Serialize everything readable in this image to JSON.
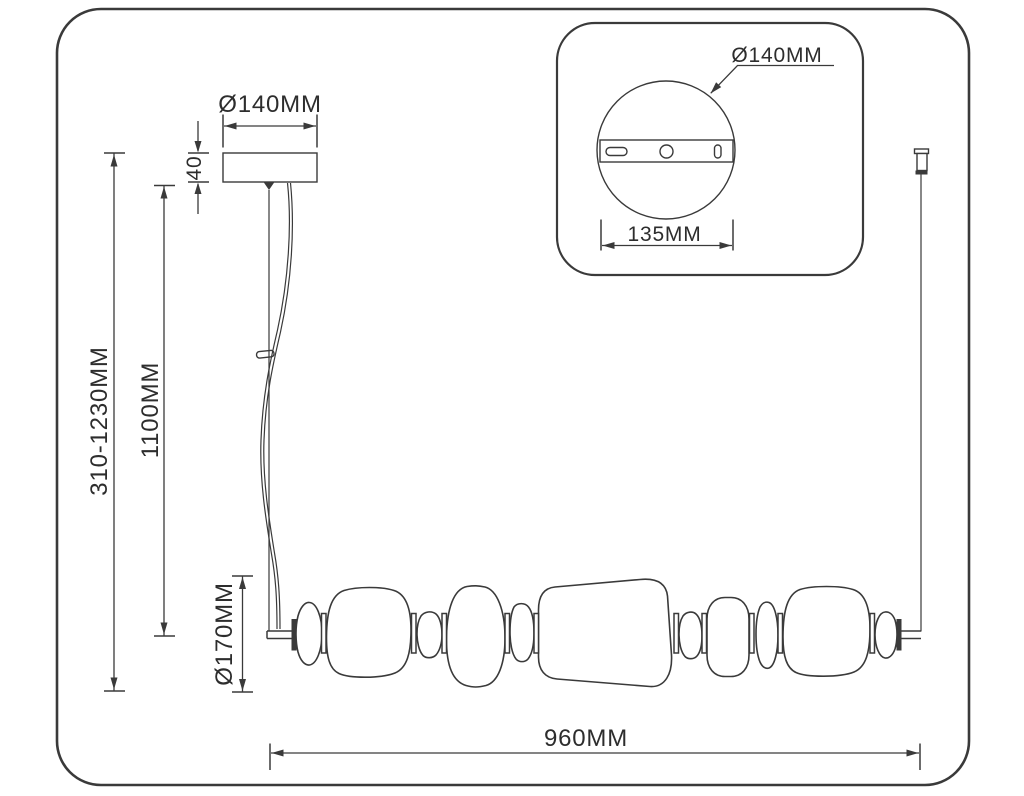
{
  "labels": {
    "canopy_diameter": "Ø140MM",
    "canopy_height": "40",
    "suspension_range": "310-1230MM",
    "cable_length": "1100MM",
    "shade_diameter": "Ø170MM",
    "fixture_width": "960MM"
  },
  "inset": {
    "plate_diameter": "Ø140MM",
    "bracket_spacing": "135MM"
  },
  "colors": {
    "line": "#3a3a3a",
    "text": "#2d2d2d",
    "background": "#ffffff"
  }
}
